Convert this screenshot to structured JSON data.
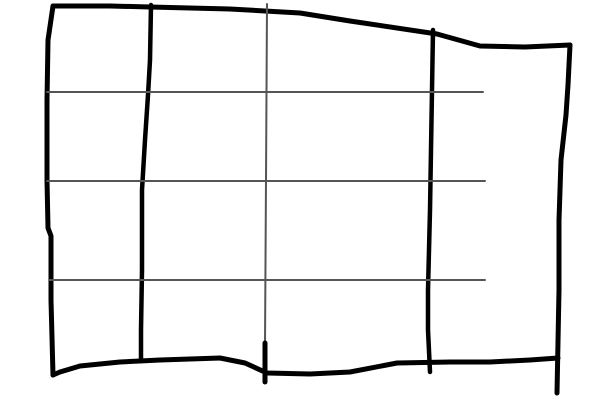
{
  "canvas": {
    "width": 600,
    "height": 400,
    "background": "#ffffff",
    "description": "Hand-drawn sketch of a 4x4 table grid"
  },
  "colors": {
    "ink": "#000000",
    "grid_gray": "#555555"
  },
  "chart_data": {
    "type": "table",
    "title": "",
    "rows": 4,
    "columns": 4,
    "cells_empty": true,
    "row_separator_y": [
      92,
      181,
      280
    ],
    "column_separator_x": [
      150,
      266,
      431
    ],
    "outer_bounds": {
      "left": 47,
      "top": 6,
      "right": 570,
      "bottom": 375
    }
  },
  "strokes": [
    {
      "name": "outer-border-top",
      "color": "ink",
      "width": 5,
      "points": [
        [
          53,
          6
        ],
        [
          110,
          6
        ],
        [
          150,
          7
        ],
        [
          230,
          9
        ],
        [
          300,
          13
        ],
        [
          350,
          21
        ],
        [
          437,
          34
        ],
        [
          480,
          46
        ],
        [
          525,
          47
        ],
        [
          570,
          45
        ]
      ]
    },
    {
      "name": "outer-border-left",
      "color": "ink",
      "width": 5,
      "points": [
        [
          53,
          6
        ],
        [
          48,
          40
        ],
        [
          47,
          100
        ],
        [
          47,
          180
        ],
        [
          48,
          228
        ],
        [
          51,
          236
        ],
        [
          51,
          300
        ],
        [
          53,
          375
        ]
      ]
    },
    {
      "name": "outer-border-right",
      "color": "ink",
      "width": 5,
      "points": [
        [
          570,
          45
        ],
        [
          568,
          85
        ],
        [
          566,
          115
        ],
        [
          561,
          160
        ],
        [
          559,
          220
        ],
        [
          559,
          290
        ],
        [
          557,
          393
        ]
      ]
    },
    {
      "name": "outer-border-bottom",
      "color": "ink",
      "width": 5,
      "points": [
        [
          53,
          375
        ],
        [
          60,
          372
        ],
        [
          80,
          366
        ],
        [
          120,
          362
        ],
        [
          160,
          360
        ],
        [
          220,
          358
        ],
        [
          245,
          363
        ],
        [
          267,
          373
        ],
        [
          310,
          374
        ],
        [
          350,
          372
        ],
        [
          397,
          363
        ],
        [
          450,
          362
        ],
        [
          490,
          362
        ],
        [
          530,
          360
        ],
        [
          558,
          358
        ]
      ]
    },
    {
      "name": "column-line-1-thick",
      "color": "ink",
      "width": 4.5,
      "points": [
        [
          151,
          5
        ],
        [
          150,
          60
        ],
        [
          148,
          95
        ],
        [
          145,
          140
        ],
        [
          142,
          190
        ],
        [
          142,
          270
        ],
        [
          141,
          330
        ],
        [
          141,
          361
        ]
      ]
    },
    {
      "name": "column-line-3-thick",
      "color": "ink",
      "width": 4.5,
      "points": [
        [
          433,
          30
        ],
        [
          432,
          90
        ],
        [
          431,
          150
        ],
        [
          430,
          210
        ],
        [
          428,
          290
        ],
        [
          428,
          330
        ],
        [
          430,
          372
        ]
      ]
    },
    {
      "name": "column-line-2-thin",
      "color": "grid_gray",
      "width": 2,
      "points": [
        [
          267,
          4
        ],
        [
          266,
          180
        ],
        [
          265,
          345
        ]
      ]
    },
    {
      "name": "column-line-2-bottom-tick",
      "color": "ink",
      "width": 5,
      "points": [
        [
          265,
          343
        ],
        [
          265,
          382
        ]
      ]
    },
    {
      "name": "row-line-1",
      "color": "grid_gray",
      "width": 2,
      "points": [
        [
          47,
          92
        ],
        [
          483,
          92
        ]
      ]
    },
    {
      "name": "row-line-2",
      "color": "grid_gray",
      "width": 2,
      "points": [
        [
          47,
          181
        ],
        [
          485,
          181
        ]
      ]
    },
    {
      "name": "row-line-3",
      "color": "grid_gray",
      "width": 2,
      "points": [
        [
          49,
          280
        ],
        [
          485,
          280
        ]
      ]
    }
  ]
}
